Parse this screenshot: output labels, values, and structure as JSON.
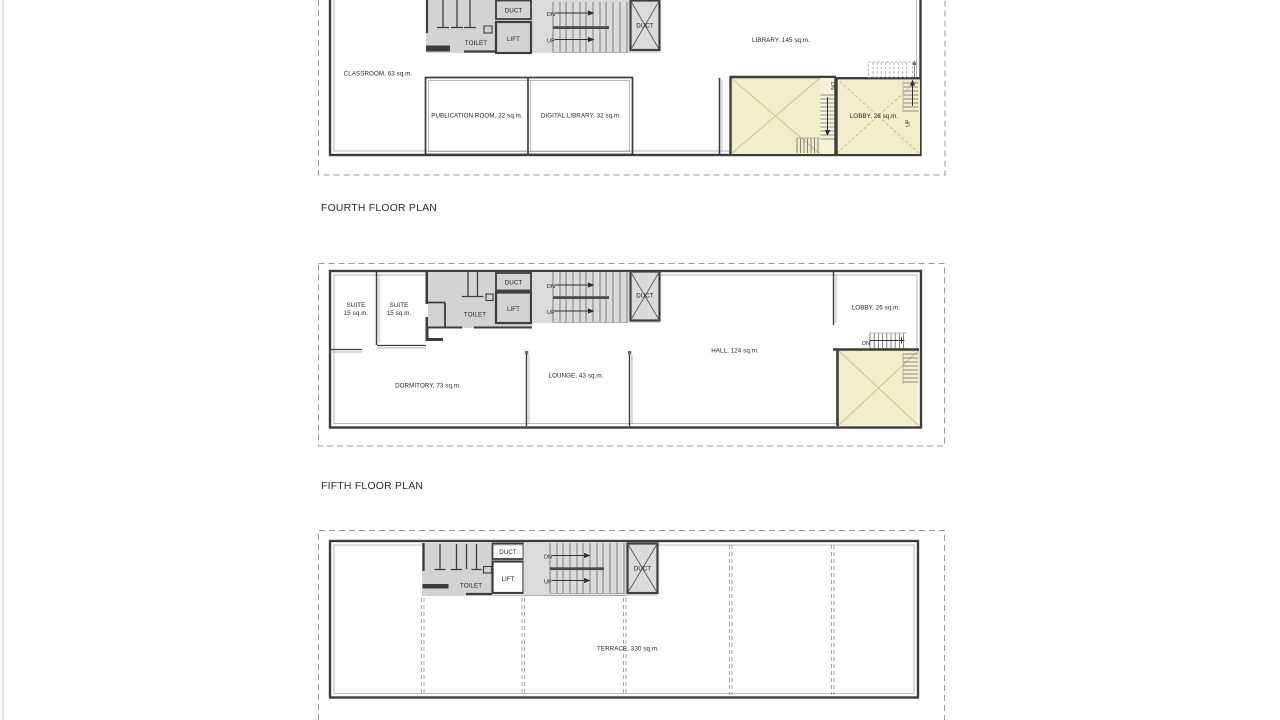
{
  "colors": {
    "wall": "#3d3d3f",
    "floor_fill": "#ededef",
    "core_landing": "#dbdbdd",
    "toilet_fill": "#d3d3d5",
    "duct_box": "#c7c7c9",
    "lift_box": "#b2b2b4",
    "duct_shaft": "#c2c2c4",
    "void_yellow": "#f1eec9",
    "stair_strip_yellow": "#f5f3d8",
    "dashed_border": "#9a9a9a"
  },
  "plan_fourth": {
    "title": "FOURTH FLOOR PLAN",
    "labels": {
      "classroom": "CLASSROOM, 63 sq.m.",
      "publication_room": "PUBLICATION ROOM, 32 sq.m.",
      "digital_library": "DIGITAL LIBRARY, 32 sq.m.",
      "library": "LIBRARY, 145 sq.m.",
      "lobby": "LOBBY, 26 sq.m.",
      "toilet": "TOILET",
      "duct": "DUCT",
      "lift": "LIFT",
      "duct_shaft": "DUCT",
      "stair_dn": "DN",
      "stair_up": "UP",
      "void_dn": "DN",
      "lobby_up": "UP"
    }
  },
  "plan_fifth": {
    "title": "FIFTH FLOOR PLAN",
    "labels": {
      "suite1_name": "SUITE",
      "suite1_area": "15 sq.m.",
      "suite2_name": "SUITE",
      "suite2_area": "15 sq.m.",
      "dormitory": "DORMITORY, 73 sq.m.",
      "lounge": "LOUNGE, 43 sq.m.",
      "hall": "HALL, 124 sq.m.",
      "lobby": "LOBBY, 26 sq.m.",
      "toilet": "TOILET",
      "duct": "DUCT",
      "lift": "LIFT",
      "duct_shaft": "DUCT",
      "stair_dn": "DN",
      "stair_up": "UP",
      "lobby_dn": "DN"
    }
  },
  "plan_terrace": {
    "labels": {
      "terrace": "TERRACE, 330 sq.m.",
      "toilet": "TOILET",
      "duct": "DUCT",
      "lift": "LIFT",
      "duct_shaft": "DUCT",
      "stair_dn": "DN",
      "stair_up": "UP"
    }
  }
}
